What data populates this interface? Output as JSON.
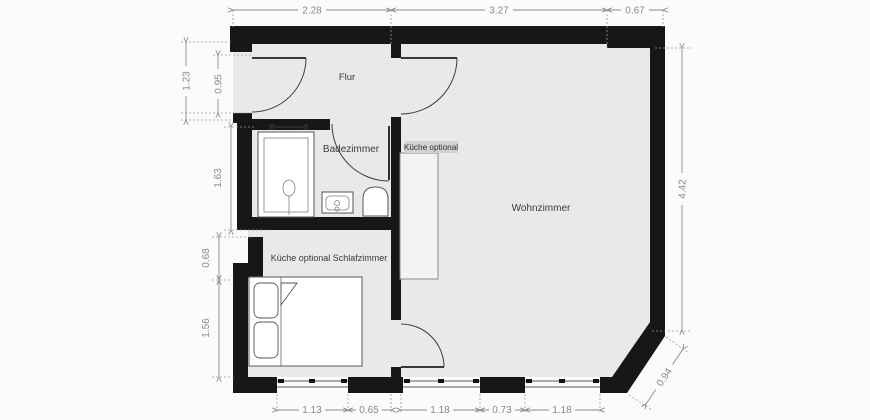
{
  "plan": {
    "rooms": {
      "flur": "Flur",
      "badezimmer": "Badezimmer",
      "wohnzimmer": "Wohnzimmer",
      "schlafzimmer": "Küche optional Schlafzimmer",
      "kueche_chip": "Küche optional"
    },
    "dimensions": {
      "top": [
        "2.28",
        "3.27",
        "0.67"
      ],
      "left_outer": [
        "1.23",
        "0.95"
      ],
      "left_inner": [
        "1.63",
        "0.68",
        "1.56"
      ],
      "right": [
        "4.42"
      ],
      "diagonal": [
        "0.94"
      ],
      "bottom": [
        "1.13",
        "0.65",
        "1.18",
        "0.73",
        "1.18"
      ]
    },
    "colors": {
      "wall": "#171717",
      "floor": "#e9e9ec",
      "background": "#fbfbfb",
      "dimension_text": "#8a8a8a",
      "room_label": "#3a3a3a",
      "kueche_chip_bg": "#d2d2d2"
    }
  }
}
